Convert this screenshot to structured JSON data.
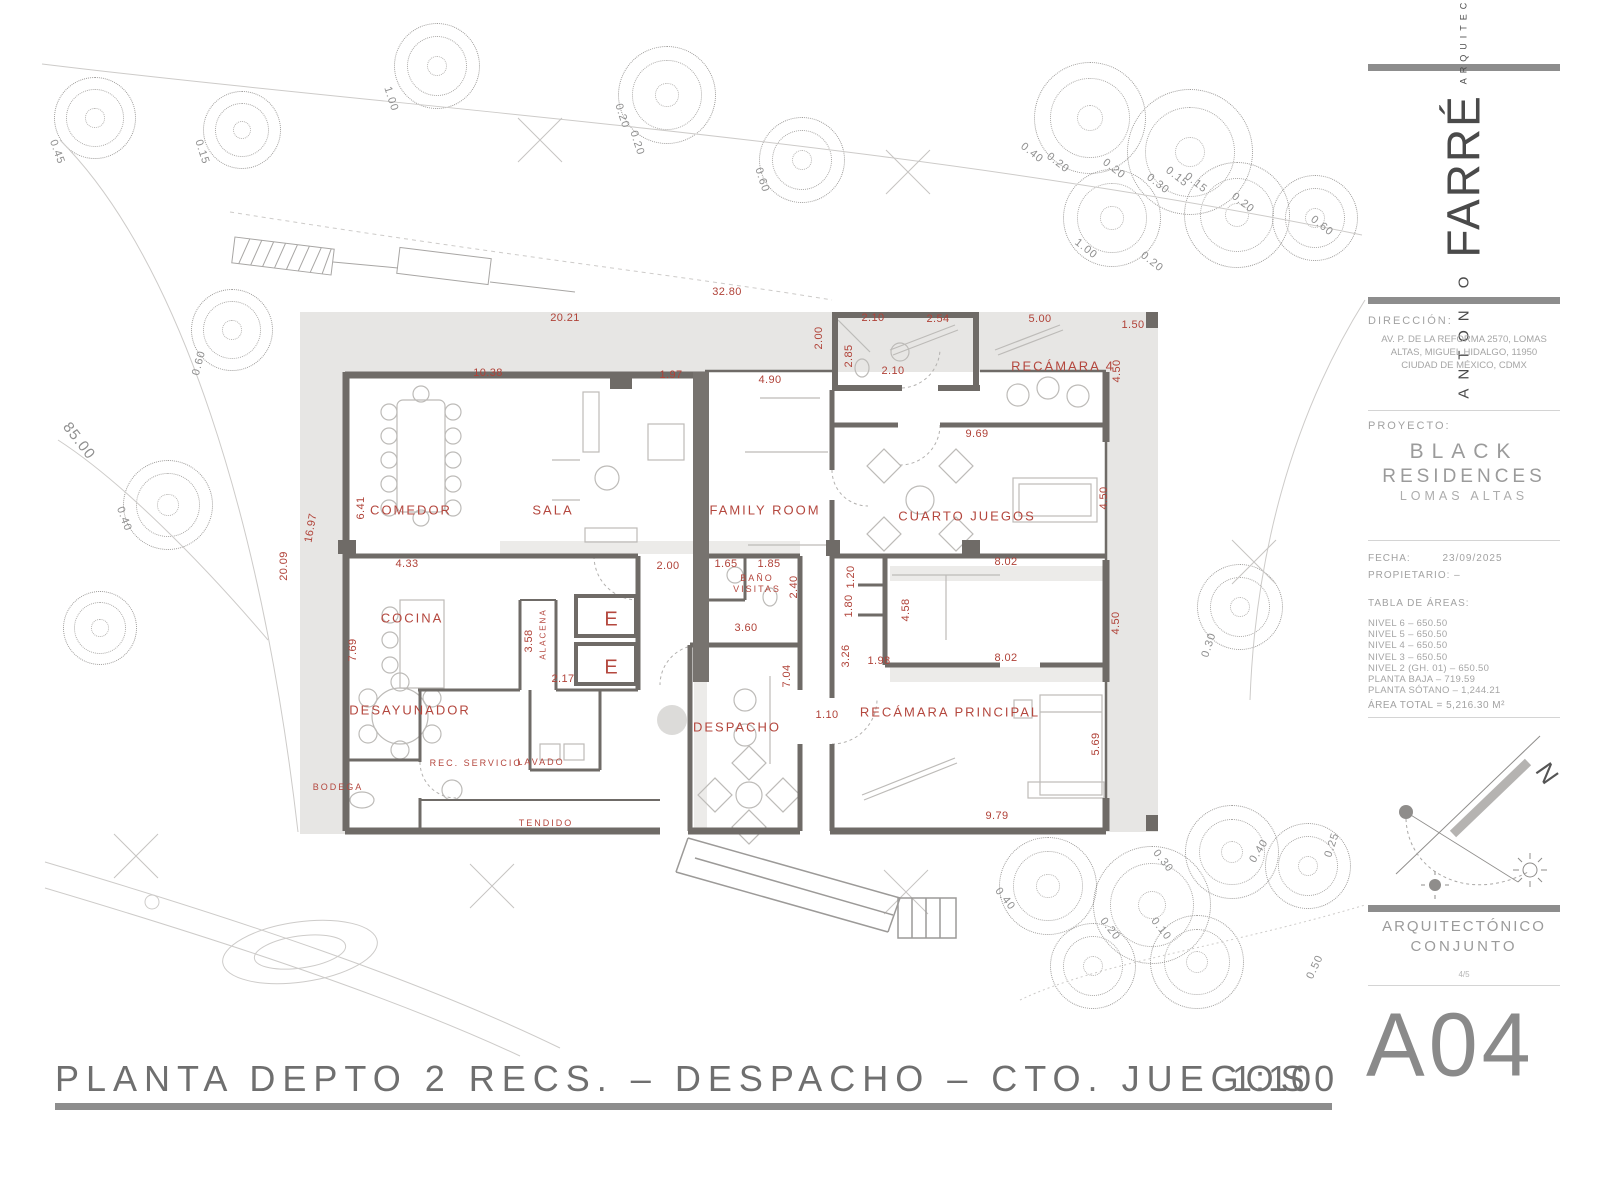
{
  "colors": {
    "dimension_red": "#b04238",
    "room_red": "#b4473e",
    "wall_gray": "#6f6b67",
    "terrace_gray": "#e7e6e4",
    "panel_text_gray": "#9b9b9b",
    "bar_gray": "#8d8d8d"
  },
  "title_block": {
    "architect_first": "ANTONIO",
    "architect_last": "FARRÉ",
    "architect_role": "ARQUITECTO",
    "direccion_label": "DIRECCIÓN:",
    "direccion_lines": [
      "AV. P. DE LA REFORMA 2570, LOMAS",
      "ALTAS, MIGUEL HIDALGO, 11950",
      "CIUDAD DE MÉXICO, CDMX"
    ],
    "proyecto_label": "PROYECTO:",
    "proyecto_name_line1": "BLACK",
    "proyecto_name_line2": "RESIDENCES",
    "proyecto_sub": "LOMAS ALTAS",
    "fecha_label": "FECHA:",
    "fecha_value": "23/09/2025",
    "propietario_label": "PROPIETARIO: –",
    "tabla_label": "TABLA DE ÁREAS:",
    "tabla_rows": [
      "NIVEL 6 – 650.50",
      "NIVEL 5 – 650.50",
      "NIVEL 4 – 650.50",
      "NIVEL 3 – 650.50",
      "NIVEL 2 (GH. 01) – 650.50",
      "PLANTA BAJA – 719.59",
      "PLANTA SÓTANO – 1,244.21"
    ],
    "area_total": "ÁREA TOTAL = 5,216.30 M²",
    "north_label": "N",
    "sheet_type_line1": "ARQUITECTÓNICO",
    "sheet_type_line2": "CONJUNTO",
    "sheet_index": "4/5",
    "sheet_code": "A04"
  },
  "footer": {
    "title": "PLANTA DEPTO 2 RECS. – DESPACHO – CTO. JUEGOS",
    "scale": "1:100"
  },
  "plan": {
    "room_labels": [
      {
        "t": "COMEDOR",
        "x": 411,
        "y": 510
      },
      {
        "t": "SALA",
        "x": 553,
        "y": 510
      },
      {
        "t": "FAMILY ROOM",
        "x": 765,
        "y": 510
      },
      {
        "t": "RECÁMARA 4",
        "x": 1063,
        "y": 366
      },
      {
        "t": "CUARTO JUEGOS",
        "x": 967,
        "y": 516
      },
      {
        "t": "COCINA",
        "x": 412,
        "y": 618
      },
      {
        "t": "DESAYUNADOR",
        "x": 410,
        "y": 710
      },
      {
        "t": "DESPACHO",
        "x": 737,
        "y": 727
      },
      {
        "t": "RECÁMARA PRINCIPAL",
        "x": 950,
        "y": 712
      },
      {
        "t": "BAÑO",
        "x": 757,
        "y": 578,
        "s": 9
      },
      {
        "t": "VISITAS",
        "x": 757,
        "y": 589,
        "s": 9
      },
      {
        "t": "REC. SERVICIO",
        "x": 476,
        "y": 763,
        "s": 9
      },
      {
        "t": "LAVADO",
        "x": 541,
        "y": 762,
        "s": 9
      },
      {
        "t": "BODEGA",
        "x": 338,
        "y": 787,
        "s": 9
      },
      {
        "t": "TENDIDO",
        "x": 546,
        "y": 823,
        "s": 9
      },
      {
        "t": "ALACENA",
        "x": 543,
        "y": 634,
        "s": 8,
        "r": -90
      },
      {
        "t": "E",
        "x": 612,
        "y": 620,
        "s": 20
      },
      {
        "t": "E",
        "x": 612,
        "y": 668,
        "s": 20
      }
    ],
    "dim_labels": [
      {
        "t": "32.80",
        "x": 727,
        "y": 292
      },
      {
        "t": "20.21",
        "x": 565,
        "y": 318
      },
      {
        "t": "10.38",
        "x": 488,
        "y": 373
      },
      {
        "t": "1.97",
        "x": 671,
        "y": 375
      },
      {
        "t": "4.90",
        "x": 770,
        "y": 380
      },
      {
        "t": "2.00",
        "x": 819,
        "y": 338,
        "r": -90
      },
      {
        "t": "2.10",
        "x": 873,
        "y": 318
      },
      {
        "t": "2.54",
        "x": 938,
        "y": 319
      },
      {
        "t": "5.00",
        "x": 1040,
        "y": 319
      },
      {
        "t": "1.50",
        "x": 1133,
        "y": 325
      },
      {
        "t": "2.85",
        "x": 849,
        "y": 356,
        "r": -90
      },
      {
        "t": "2.10",
        "x": 893,
        "y": 371
      },
      {
        "t": "4.50",
        "x": 1117,
        "y": 371,
        "r": -90
      },
      {
        "t": "9.69",
        "x": 977,
        "y": 434
      },
      {
        "t": "4.50",
        "x": 1104,
        "y": 498,
        "r": -90
      },
      {
        "t": "6.41",
        "x": 361,
        "y": 508,
        "r": -90
      },
      {
        "t": "16.97",
        "x": 311,
        "y": 528,
        "r": -80
      },
      {
        "t": "20.09",
        "x": 284,
        "y": 566,
        "r": -90
      },
      {
        "t": "4.33",
        "x": 407,
        "y": 564
      },
      {
        "t": "2.00",
        "x": 668,
        "y": 566
      },
      {
        "t": "1.65",
        "x": 726,
        "y": 564
      },
      {
        "t": "1.85",
        "x": 769,
        "y": 564
      },
      {
        "t": "2.40",
        "x": 794,
        "y": 587,
        "r": -90
      },
      {
        "t": "3.60",
        "x": 746,
        "y": 628
      },
      {
        "t": "7.69",
        "x": 353,
        "y": 650,
        "r": -90
      },
      {
        "t": "3.58",
        "x": 529,
        "y": 641,
        "r": -90
      },
      {
        "t": "2.17",
        "x": 563,
        "y": 679
      },
      {
        "t": "1.20",
        "x": 851,
        "y": 577,
        "r": -90
      },
      {
        "t": "1.80",
        "x": 849,
        "y": 606,
        "r": -90
      },
      {
        "t": "3.26",
        "x": 846,
        "y": 656,
        "r": -90
      },
      {
        "t": "1.98",
        "x": 879,
        "y": 661
      },
      {
        "t": "4.58",
        "x": 906,
        "y": 610,
        "r": -90
      },
      {
        "t": "8.02",
        "x": 1006,
        "y": 562
      },
      {
        "t": "8.02",
        "x": 1006,
        "y": 658
      },
      {
        "t": "4.50",
        "x": 1116,
        "y": 623,
        "r": -90
      },
      {
        "t": "7.04",
        "x": 787,
        "y": 676,
        "r": -90
      },
      {
        "t": "1.10",
        "x": 827,
        "y": 715
      },
      {
        "t": "5.69",
        "x": 1096,
        "y": 744,
        "r": -90
      },
      {
        "t": "9.79",
        "x": 997,
        "y": 816
      }
    ],
    "site_labels": [
      {
        "t": "85.00",
        "x": 79,
        "y": 441,
        "r": 52,
        "s": 15
      },
      {
        "t": "0.45",
        "x": 57,
        "y": 152,
        "r": 70
      },
      {
        "t": "0.15",
        "x": 202,
        "y": 152,
        "r": 72
      },
      {
        "t": "1.00",
        "x": 391,
        "y": 99,
        "r": 72
      },
      {
        "t": "0.20",
        "x": 622,
        "y": 116,
        "r": 72
      },
      {
        "t": "0.20",
        "x": 637,
        "y": 143,
        "r": 72
      },
      {
        "t": "0.60",
        "x": 762,
        "y": 180,
        "r": 72
      },
      {
        "t": "0.40",
        "x": 1032,
        "y": 153,
        "r": 38
      },
      {
        "t": "0.20",
        "x": 1058,
        "y": 163,
        "r": 38
      },
      {
        "t": "0.20",
        "x": 1114,
        "y": 169,
        "r": 38
      },
      {
        "t": "0.30",
        "x": 1158,
        "y": 184,
        "r": 38
      },
      {
        "t": "0.15",
        "x": 1177,
        "y": 177,
        "r": 38
      },
      {
        "t": "0.15",
        "x": 1196,
        "y": 183,
        "r": 38
      },
      {
        "t": "0.20",
        "x": 1243,
        "y": 203,
        "r": 38
      },
      {
        "t": "0.60",
        "x": 1322,
        "y": 226,
        "r": 38
      },
      {
        "t": "1.00",
        "x": 1086,
        "y": 249,
        "r": 38
      },
      {
        "t": "0.20",
        "x": 1152,
        "y": 262,
        "r": 38
      },
      {
        "t": "0.60",
        "x": 199,
        "y": 363,
        "r": -75
      },
      {
        "t": "0.40",
        "x": 124,
        "y": 519,
        "r": 70
      },
      {
        "t": "0.30",
        "x": 1209,
        "y": 645,
        "r": -72
      },
      {
        "t": "0.40",
        "x": 1005,
        "y": 899,
        "r": 52
      },
      {
        "t": "0.30",
        "x": 1163,
        "y": 861,
        "r": 52
      },
      {
        "t": "0.20",
        "x": 1110,
        "y": 929,
        "r": 52
      },
      {
        "t": "0.10",
        "x": 1161,
        "y": 929,
        "r": 52
      },
      {
        "t": "0.40",
        "x": 1259,
        "y": 851,
        "r": -58
      },
      {
        "t": "0.25",
        "x": 1332,
        "y": 845,
        "r": -72
      },
      {
        "t": "0.50",
        "x": 1315,
        "y": 967,
        "r": -65
      }
    ],
    "trees": [
      {
        "x": 95,
        "y": 118,
        "d": 80
      },
      {
        "x": 242,
        "y": 130,
        "d": 76
      },
      {
        "x": 437,
        "y": 66,
        "d": 84
      },
      {
        "x": 667,
        "y": 95,
        "d": 96
      },
      {
        "x": 802,
        "y": 160,
        "d": 84
      },
      {
        "x": 1090,
        "y": 118,
        "d": 110
      },
      {
        "x": 1190,
        "y": 152,
        "d": 124
      },
      {
        "x": 1112,
        "y": 218,
        "d": 96
      },
      {
        "x": 1237,
        "y": 215,
        "d": 104
      },
      {
        "x": 1315,
        "y": 218,
        "d": 84
      },
      {
        "x": 232,
        "y": 330,
        "d": 80
      },
      {
        "x": 168,
        "y": 505,
        "d": 88
      },
      {
        "x": 100,
        "y": 628,
        "d": 72
      },
      {
        "x": 1240,
        "y": 607,
        "d": 84
      },
      {
        "x": 1048,
        "y": 886,
        "d": 96
      },
      {
        "x": 1152,
        "y": 905,
        "d": 116
      },
      {
        "x": 1232,
        "y": 852,
        "d": 92
      },
      {
        "x": 1308,
        "y": 866,
        "d": 84
      },
      {
        "x": 1093,
        "y": 966,
        "d": 84
      },
      {
        "x": 1197,
        "y": 962,
        "d": 92
      }
    ]
  }
}
